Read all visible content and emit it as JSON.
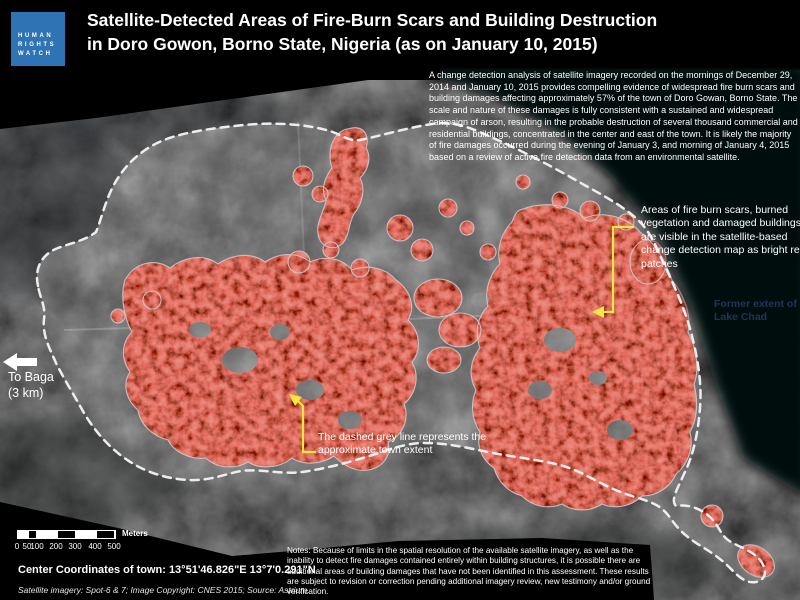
{
  "header": {
    "logo": [
      "HUMAN",
      "RIGHTS",
      "WATCH"
    ],
    "title1": "Satellite-Detected Areas of Fire-Burn Scars and Building Destruction",
    "title2": "in Doro Gowon, Borno State, Nigeria (as on January 10, 2015)"
  },
  "intro": "A change detection analysis of satellite imagery recorded on the mornings of December 29, 2014 and January 10, 2015 provides compelling evidence of widespread fire burn scars and building damages affecting approximately 57% of the town of Doro Gowan, Borno State. The scale and nature of these damages is fully consistent with a sustained and widespread campaign of arson, resulting in the probable destruction of several thousand commercial and residential buildings, concentrated in the center and east of the town. It is likely the majority of fire damages occurred during the evening of January 3, and morning of January 4, 2015 based on a review of active fire detection data from an environmental satellite.",
  "callouts": {
    "fire": "Areas of fire burn scars, burned vegetation and damaged buildings are visible in the satellite-based change detection map as bright red patches",
    "lake1": "Former extent of",
    "lake2": "Lake Chad",
    "baga1": "To Baga",
    "baga2": "(3 km)",
    "extent": "The dashed grey line represents the approximate town extent"
  },
  "scale": {
    "ticks": [
      "0",
      "50",
      "100",
      "200",
      "300",
      "400",
      "500"
    ],
    "unit": "Meters"
  },
  "footer": {
    "coords": "Center Coordinates of town: 13°51'46.826\"E  13°7'0.291\"N",
    "credit": "Satellite imagery: Spot-6 & 7; Image Copyright: CNES 2015; Source: Astrium.",
    "notes": "Notes: Because of limits in the spatial resolution of the available satellite imagery, as well as the inability to detect fire damages contained entirely within building structures, it is possible there are additional areas of building damages that have not been identified in this assessment. These results are subject to revision or correction pending additional imagery review, new testimony and/or ground verification."
  },
  "colors": {
    "hrw_blue": "#2e74b5",
    "burn_red": "#a8261b",
    "callout_yellow": "#f3e93d",
    "lake_label_navy": "#223459",
    "town_outline": "#ededed"
  }
}
